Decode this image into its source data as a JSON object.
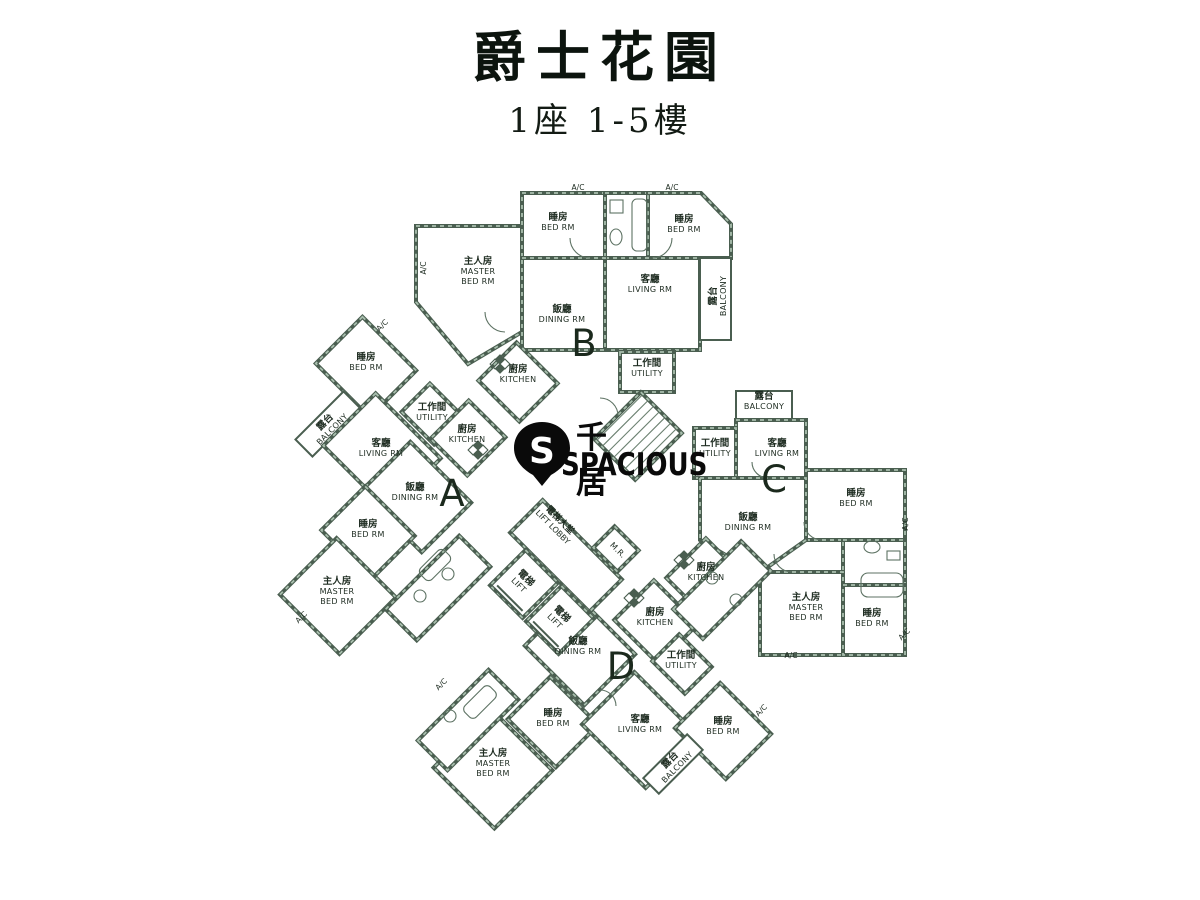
{
  "header": {
    "title": "爵士花園",
    "subtitle": "1座 1-5樓"
  },
  "watermark": {
    "zh": "千居",
    "en": "SPACIOUS",
    "letter": "S"
  },
  "palette": {
    "wall": "#4a5e50",
    "wall_light": "#a9bfae",
    "line": "#5d7263",
    "text": "#1d2b20",
    "letter": "#1b291d"
  },
  "floorplan": {
    "unit_letters": [
      {
        "letter": "A",
        "x": 452,
        "y": 506
      },
      {
        "letter": "B",
        "x": 584,
        "y": 356
      },
      {
        "letter": "C",
        "x": 774,
        "y": 492
      },
      {
        "letter": "D",
        "x": 621,
        "y": 679
      }
    ],
    "rooms": [
      {
        "id": "b-master-bed",
        "zh": "主人房",
        "en": "MASTER|BED RM",
        "shape": "poly",
        "points": "416,226 522,226 522,332 468,364 416,302",
        "lx": 478,
        "ly": 264
      },
      {
        "id": "b-bed-1",
        "zh": "睡房",
        "en": "BED RM",
        "shape": "rect",
        "x": 522,
        "y": 193,
        "w": 83,
        "h": 65,
        "lx": 558,
        "ly": 220
      },
      {
        "id": "b-bath",
        "shape": "rect",
        "x": 605,
        "y": 193,
        "w": 43,
        "h": 65
      },
      {
        "id": "b-bed-2",
        "zh": "睡房",
        "en": "BED RM",
        "shape": "poly",
        "points": "648,193 701,193 731,224 731,258 648,258",
        "lx": 684,
        "ly": 222
      },
      {
        "id": "b-living",
        "zh": "客廳",
        "en": "LIVING RM",
        "shape": "rect",
        "x": 605,
        "y": 258,
        "w": 95,
        "h": 92,
        "lx": 650,
        "ly": 282
      },
      {
        "id": "b-dining",
        "zh": "飯廳",
        "en": "DINING RM",
        "shape": "rect",
        "x": 522,
        "y": 258,
        "w": 83,
        "h": 92,
        "lx": 562,
        "ly": 312
      },
      {
        "id": "b-balcony",
        "zh": "露台",
        "en": "BALCONY",
        "shape": "rect",
        "x": 700,
        "y": 258,
        "w": 31,
        "h": 82,
        "thin": true,
        "lx": 716,
        "ly": 296,
        "lrot": -90
      },
      {
        "id": "b-kitchen",
        "zh": "廚房",
        "en": "KITCHEN",
        "shape": "rrect",
        "cx": 518,
        "cy": 382,
        "w": 58,
        "h": 54,
        "angle": 45,
        "lx": 518,
        "ly": 372
      },
      {
        "id": "b-utility",
        "zh": "工作間",
        "en": "UTILITY",
        "shape": "rect",
        "x": 620,
        "y": 352,
        "w": 54,
        "h": 40,
        "lx": 647,
        "ly": 366
      },
      {
        "id": "c-balcony",
        "zh": "露台",
        "en": "BALCONY",
        "shape": "rect",
        "x": 736,
        "y": 391,
        "w": 56,
        "h": 29,
        "thin": true,
        "lx": 764,
        "ly": 399
      },
      {
        "id": "c-living",
        "zh": "客廳",
        "en": "LIVING RM",
        "shape": "rect",
        "x": 736,
        "y": 420,
        "w": 70,
        "h": 58,
        "lx": 777,
        "ly": 446
      },
      {
        "id": "c-utility",
        "zh": "工作間",
        "en": "UTILITY",
        "shape": "rect",
        "x": 694,
        "y": 428,
        "w": 42,
        "h": 50,
        "lx": 715,
        "ly": 446
      },
      {
        "id": "c-bed-1",
        "zh": "睡房",
        "en": "BED RM",
        "shape": "rect",
        "x": 806,
        "y": 470,
        "w": 99,
        "h": 70,
        "lx": 856,
        "ly": 496
      },
      {
        "id": "c-dining",
        "zh": "飯廳",
        "en": "DINING RM",
        "shape": "poly",
        "points": "700,478 806,478 806,540 758,574 700,540",
        "lx": 748,
        "ly": 520
      },
      {
        "id": "c-kitchen",
        "zh": "廚房",
        "en": "KITCHEN",
        "shape": "rrect",
        "cx": 708,
        "cy": 580,
        "w": 62,
        "h": 56,
        "angle": 45,
        "lx": 706,
        "ly": 570
      },
      {
        "id": "c-bath",
        "shape": "rect",
        "x": 843,
        "y": 540,
        "w": 62,
        "h": 45
      },
      {
        "id": "c-master-bed",
        "zh": "主人房",
        "en": "MASTER|BED RM",
        "shape": "rect",
        "x": 760,
        "y": 572,
        "w": 83,
        "h": 83,
        "lx": 806,
        "ly": 600
      },
      {
        "id": "c-bed-2",
        "zh": "睡房",
        "en": "BED RM",
        "shape": "rect",
        "x": 843,
        "y": 585,
        "w": 62,
        "h": 70,
        "lx": 872,
        "ly": 616
      },
      {
        "id": "a-bed-1",
        "zh": "睡房",
        "en": "BED RM",
        "shape": "rrect",
        "cx": 366,
        "cy": 367,
        "w": 76,
        "h": 66,
        "angle": 45,
        "lx": 366,
        "ly": 360
      },
      {
        "id": "a-balcony",
        "zh": "露台",
        "en": "BALCONY",
        "shape": "rrect",
        "cx": 328,
        "cy": 424,
        "w": 68,
        "h": 24,
        "angle": -45,
        "thin": true,
        "lx": 327,
        "ly": 424,
        "lrot": -45
      },
      {
        "id": "a-living",
        "zh": "客廳",
        "en": "LIVING RM",
        "shape": "rrect",
        "cx": 382,
        "cy": 452,
        "w": 92,
        "h": 74,
        "angle": 45,
        "lx": 381,
        "ly": 446
      },
      {
        "id": "a-utility",
        "zh": "工作間",
        "en": "UTILITY",
        "shape": "rrect",
        "cx": 432,
        "cy": 414,
        "w": 46,
        "h": 40,
        "angle": 45,
        "lx": 432,
        "ly": 410
      },
      {
        "id": "a-kitchen",
        "zh": "廚房",
        "en": "KITCHEN",
        "shape": "rrect",
        "cx": 468,
        "cy": 438,
        "w": 52,
        "h": 54,
        "angle": 45,
        "lx": 467,
        "ly": 432
      },
      {
        "id": "a-dining",
        "zh": "飯廳",
        "en": "DINING RM",
        "shape": "rrect",
        "cx": 416,
        "cy": 497,
        "w": 86,
        "h": 70,
        "angle": 45,
        "lx": 415,
        "ly": 490
      },
      {
        "id": "a-bed-2",
        "zh": "睡房",
        "en": "BED RM",
        "shape": "rrect",
        "cx": 368,
        "cy": 533,
        "w": 70,
        "h": 62,
        "angle": 45,
        "lx": 368,
        "ly": 527
      },
      {
        "id": "a-master-bed",
        "zh": "主人房",
        "en": "MASTER|BED RM",
        "shape": "rrect",
        "cx": 338,
        "cy": 596,
        "w": 84,
        "h": 80,
        "angle": 45,
        "lx": 337,
        "ly": 584
      },
      {
        "id": "a-bath",
        "shape": "rrect",
        "cx": 438,
        "cy": 588,
        "w": 104,
        "h": 44,
        "angle": -45
      },
      {
        "id": "d-kitchen",
        "zh": "廚房",
        "en": "KITCHEN",
        "shape": "rrect",
        "cx": 656,
        "cy": 622,
        "w": 62,
        "h": 56,
        "angle": 45,
        "lx": 655,
        "ly": 615
      },
      {
        "id": "d-dining",
        "zh": "飯廳",
        "en": "DINING RM",
        "shape": "rrect",
        "cx": 580,
        "cy": 650,
        "w": 84,
        "h": 72,
        "angle": 45,
        "lx": 578,
        "ly": 644
      },
      {
        "id": "d-utility",
        "zh": "工作間",
        "en": "UTILITY",
        "shape": "rrect",
        "cx": 682,
        "cy": 664,
        "w": 46,
        "h": 38,
        "angle": 45,
        "lx": 681,
        "ly": 658
      },
      {
        "id": "d-bed-1",
        "zh": "睡房",
        "en": "BED RM",
        "shape": "rrect",
        "cx": 553,
        "cy": 722,
        "w": 68,
        "h": 60,
        "angle": 45,
        "lx": 553,
        "ly": 716
      },
      {
        "id": "d-living",
        "zh": "客廳",
        "en": "LIVING RM",
        "shape": "rrect",
        "cx": 640,
        "cy": 730,
        "w": 90,
        "h": 74,
        "angle": 45,
        "lx": 640,
        "ly": 722
      },
      {
        "id": "d-bed-2",
        "zh": "睡房",
        "en": "BED RM",
        "shape": "rrect",
        "cx": 723,
        "cy": 731,
        "w": 72,
        "h": 64,
        "angle": 45,
        "lx": 723,
        "ly": 724
      },
      {
        "id": "d-master-bed",
        "zh": "主人房",
        "en": "MASTER|BED RM",
        "shape": "rrect",
        "cx": 493,
        "cy": 769,
        "w": 86,
        "h": 82,
        "angle": 45,
        "lx": 493,
        "ly": 756
      },
      {
        "id": "d-balcony",
        "zh": "露台",
        "en": "BALCONY",
        "shape": "rrect",
        "cx": 673,
        "cy": 764,
        "w": 62,
        "h": 22,
        "angle": -45,
        "thin": true,
        "lx": 672,
        "ly": 762,
        "lrot": -45
      },
      {
        "id": "d-bath-1",
        "shape": "rrect",
        "cx": 468,
        "cy": 720,
        "w": 100,
        "h": 42,
        "angle": -45
      },
      {
        "id": "d-bath-2",
        "shape": "rrect",
        "cx": 722,
        "cy": 590,
        "w": 96,
        "h": 42,
        "angle": -45
      },
      {
        "id": "lift-lobby",
        "shape": "rrect",
        "cx": 566,
        "cy": 556,
        "w": 112,
        "h": 46,
        "angle": 45
      },
      {
        "id": "stairs",
        "shape": "rrect",
        "cx": 638,
        "cy": 436,
        "w": 58,
        "h": 66,
        "angle": 45
      },
      {
        "id": "lift-1",
        "zh": "電梯",
        "en": "LIFT",
        "shape": "rrect",
        "cx": 524,
        "cy": 584,
        "w": 46,
        "h": 50,
        "angle": 45,
        "lx": 524,
        "ly": 580,
        "lrot": 45
      },
      {
        "id": "lift-2",
        "zh": "電梯",
        "en": "LIFT",
        "shape": "rrect",
        "cx": 560,
        "cy": 620,
        "w": 46,
        "h": 50,
        "angle": 45,
        "lx": 560,
        "ly": 616,
        "lrot": 45
      },
      {
        "id": "meter-room",
        "en": "M.R.",
        "shape": "rrect",
        "cx": 616,
        "cy": 549,
        "w": 34,
        "h": 30,
        "angle": 45,
        "lx": 616,
        "ly": 552,
        "lrot": 45
      }
    ],
    "annotations": [
      {
        "zh": "電梯大堂",
        "en": "LIFT LOBBY",
        "x": 558,
        "y": 522,
        "rot": 45
      },
      {
        "text": "A/C",
        "x": 578,
        "y": 190,
        "rot": 0
      },
      {
        "text": "A/C",
        "x": 672,
        "y": 190,
        "rot": 0
      },
      {
        "text": "A/C",
        "x": 426,
        "y": 268,
        "rot": -90
      },
      {
        "text": "A/C",
        "x": 384,
        "y": 327,
        "rot": -45
      },
      {
        "text": "A/C",
        "x": 303,
        "y": 619,
        "rot": -45
      },
      {
        "text": "A/C",
        "x": 443,
        "y": 686,
        "rot": -45
      },
      {
        "text": "A/C",
        "x": 763,
        "y": 712,
        "rot": -45
      },
      {
        "text": "A/C",
        "x": 908,
        "y": 524,
        "rot": -90
      },
      {
        "text": "A/C",
        "x": 906,
        "y": 636,
        "rot": -45
      },
      {
        "text": "A/C",
        "x": 791,
        "y": 658,
        "rot": 0
      }
    ]
  }
}
